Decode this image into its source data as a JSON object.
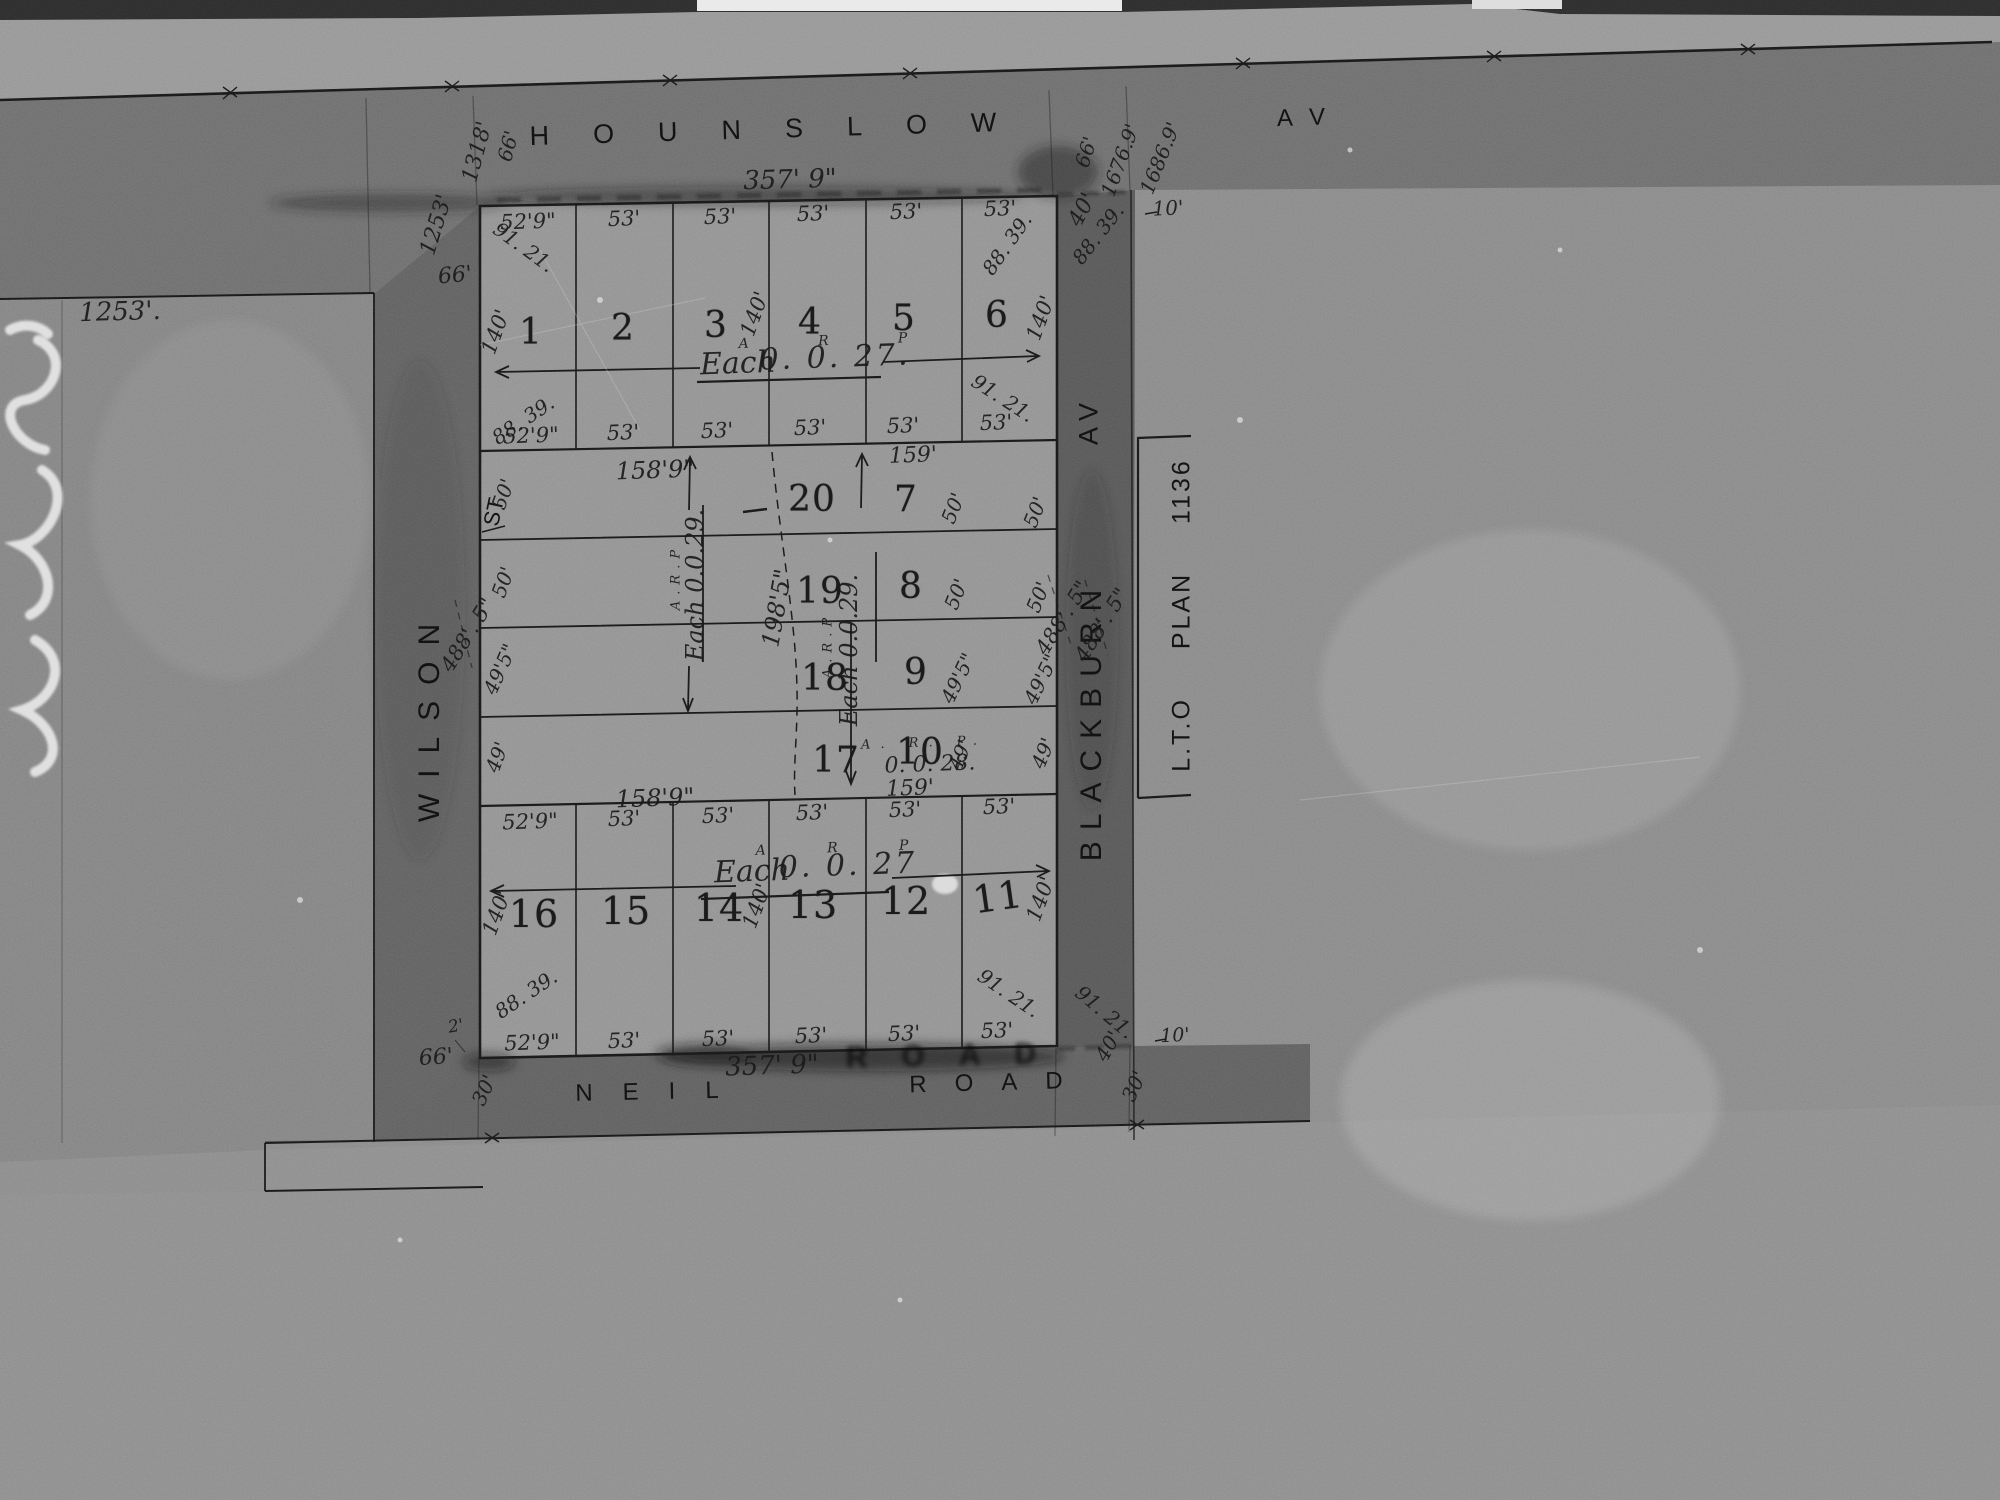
{
  "colors": {
    "paper": "#8d8d8d",
    "road": "#666666",
    "ink": "#1b1b1b",
    "chalk": "#ececec"
  },
  "streets": {
    "top": {
      "name": "HOUNSLOW",
      "suffix": "AV"
    },
    "left": {
      "name": "WILSON",
      "suffix": "ST"
    },
    "right": {
      "name": "BLACKBURN",
      "suffix": "AV"
    },
    "bottom": {
      "name": "NEIL",
      "suffix": "ROAD"
    },
    "bottom_ghost": "ROAD",
    "plan_ref": "L.T.O  PLAN  1136"
  },
  "frontages": {
    "top": "357' 9\"",
    "bottom": "357' 9\""
  },
  "tier1": {
    "lots": [
      "1",
      "2",
      "3",
      "4",
      "5",
      "6"
    ],
    "top_dims": [
      "52'9\"",
      "53'",
      "53'",
      "53'",
      "53'",
      "53'"
    ],
    "bottom_dims": [
      "52'9\"",
      "53'",
      "53'",
      "53'",
      "53'",
      "53'"
    ],
    "depth": "140'",
    "area": {
      "header": "A   R   P",
      "each": "Each",
      "value": "0. 0. 27."
    },
    "splays": {
      "top_left": "91. 21.",
      "bottom_left": "88. 39.",
      "top_right_inner": "88. 39.",
      "top_right_outer": "88. 39.",
      "bottom_right": "91. 21."
    }
  },
  "tier2": {
    "left_lots": [
      "20",
      "19",
      "18",
      "17"
    ],
    "right_lots": [
      "7",
      "8",
      "9",
      "10"
    ],
    "top_dims": [
      "158'9\"",
      "159'"
    ],
    "bottom_dims": [
      "158'9\"",
      "159'"
    ],
    "side_dims": [
      "50'",
      "50'",
      "49'5\"",
      "49'"
    ],
    "centre_depth": "198'5\"",
    "area_left": {
      "header": "A.R.P",
      "value": "Each 0.0.29."
    },
    "area_right": {
      "header": "A.R.P",
      "value": "Each 0.0.29."
    },
    "lot17_area": {
      "header": "A. R. P.",
      "value": "0. 0. 28."
    }
  },
  "tier3": {
    "lots": [
      "16",
      "15",
      "14",
      "13",
      "12",
      "11"
    ],
    "top_dims": [
      "52'9\"",
      "53'",
      "53'",
      "53'",
      "53'",
      "53'"
    ],
    "bottom_dims": [
      "52'9\"",
      "53'",
      "53'",
      "53'",
      "53'",
      "53'"
    ],
    "depth": "140'",
    "area": {
      "header": "A   R   P",
      "each": "Each",
      "value": "0. 0. 27"
    },
    "splays": {
      "bottom_left": "88. 39.",
      "bottom_right": "91. 21.",
      "road_corner": "91. 21."
    }
  },
  "road_dims": {
    "left_boundary": "1253'.",
    "left_boundary_rot": "1253'",
    "top_left_1318": "1318'",
    "top_left_66": "66'",
    "wilson_width_top": "66'",
    "wilson_width_bottom": "66'",
    "top_right_66": "66'",
    "top_right_a": "1676.9'",
    "top_right_b": "1686.9'",
    "top_right_40": "40'",
    "top_right_10": "10'",
    "west_side": "488'. 5\"",
    "east_side_a": "488'. 5\"",
    "east_side_b": "488'. 5\"",
    "bottom_left_2": "2'",
    "bottom_left_30": "30'",
    "bottom_right_30": "30'",
    "bottom_right_40": "40'",
    "bottom_right_10": "10'"
  }
}
